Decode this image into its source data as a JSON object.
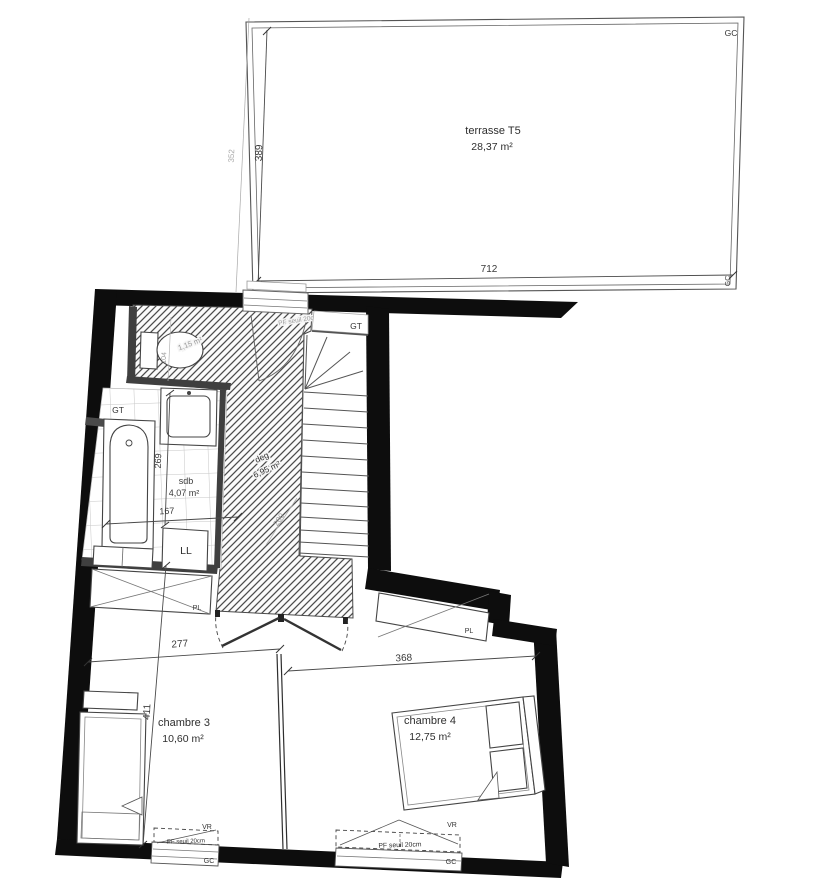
{
  "terrace": {
    "name": "terrasse T5",
    "area": "28,37 m²",
    "width_dim": "712",
    "depth_dim": "389",
    "outer_depth_dim": "352",
    "corner_top": "GC",
    "corner_bottom": "GC"
  },
  "hall": {
    "name": "deg",
    "area": "6,95 m²",
    "stair_dim": "280",
    "door_label": "PF seuil 20cm"
  },
  "wc": {
    "area": "1,15 m²",
    "dim": "104"
  },
  "sdb": {
    "name": "sdb",
    "area": "4,07 m²",
    "height_dim": "269",
    "width_dim": "167",
    "washer": "LL",
    "duct": "GT"
  },
  "stairs": {
    "duct": "GT"
  },
  "chambre3": {
    "name": "chambre 3",
    "area": "10,60 m²",
    "width_dim": "277",
    "height_dim": "411",
    "closet": "PL",
    "window": {
      "shutter": "VR",
      "sill": "PF seuil 20cm",
      "gutter": "GC"
    }
  },
  "chambre4": {
    "name": "chambre 4",
    "area": "12,75 m²",
    "width_dim": "368",
    "closet": "PL",
    "window": {
      "shutter": "VR",
      "sill": "PF seuil 20cm",
      "gutter": "GC"
    }
  }
}
